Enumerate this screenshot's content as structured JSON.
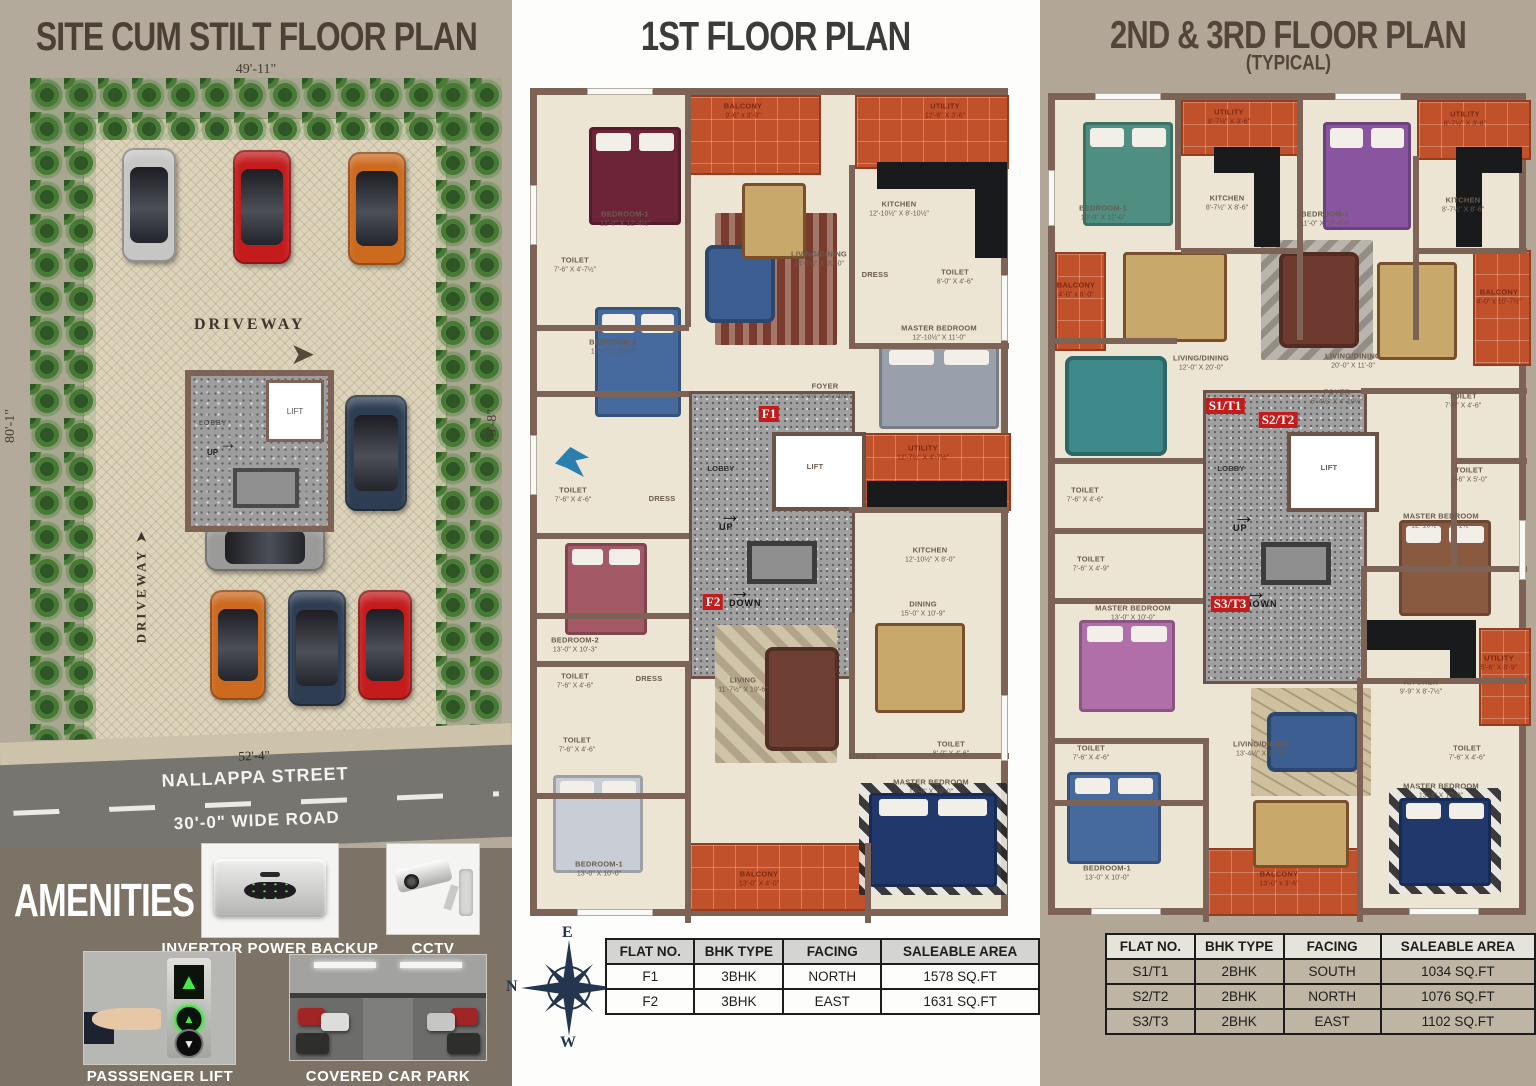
{
  "site_plan": {
    "title": "SITE CUM STILT FLOOR PLAN",
    "dim_top": "49'-11\"",
    "dim_left": "80'-1\"",
    "dim_right": "79'-8\"",
    "dim_bottom": "52'-4\"",
    "street_name": "NALLAPPA STREET",
    "road_width": "30'-0\" WIDE ROAD",
    "driveway_label": "DRIVEWAY",
    "lift": "LIFT",
    "lobby": "LOBBY",
    "up": "UP"
  },
  "first_floor": {
    "title": "1ST  FLOOR PLAN",
    "stair": {
      "up": "UP",
      "down": "DOWN"
    },
    "flat_tags": [
      "F1",
      "F2"
    ],
    "rooms": [
      {
        "name": "BALCONY",
        "dims": "9'-6\" x 3'-9\""
      },
      {
        "name": "UTILITY",
        "dims": "12'-6\" X 3'-6\""
      },
      {
        "name": "BEDROOM-1",
        "dims": "12'-0\" X 12'-4½\""
      },
      {
        "name": "KITCHEN",
        "dims": "12'-10½\" X 8'-10½\""
      },
      {
        "name": "LIVING/DINING",
        "dims": "14'-1½\" X 20'-0\""
      },
      {
        "name": "TOILET",
        "dims": "7'-6\" X 4'-7½\""
      },
      {
        "name": "DRESS"
      },
      {
        "name": "TOILET",
        "dims": "8'-0\" X 4'-6\""
      },
      {
        "name": "BEDROOM-2",
        "dims": "12'-0\" X 15'-0\""
      },
      {
        "name": "MASTER BEDROOM",
        "dims": "12'-10½\" X 11'-0\""
      },
      {
        "name": "FOYER",
        "dims": "5'-4½\" X 4'-10½\""
      },
      {
        "name": "LOBBY"
      },
      {
        "name": "LIFT"
      },
      {
        "name": "UTILITY",
        "dims": "12'-7½\" X 4'-7½\""
      },
      {
        "name": "TOILET",
        "dims": "7'-6\" X 4'-6\""
      },
      {
        "name": "DRESS"
      },
      {
        "name": "KITCHEN",
        "dims": "12'-10½\" X 8'-0\""
      },
      {
        "name": "DINING",
        "dims": "15'-0\" X 10'-9\""
      },
      {
        "name": "BEDROOM-2",
        "dims": "13'-0\" X 10'-3\""
      },
      {
        "name": "TOILET",
        "dims": "7'-6\" X 4'-6\""
      },
      {
        "name": "DRESS"
      },
      {
        "name": "LIVING",
        "dims": "11'-7½\" X 19'-6\""
      },
      {
        "name": "TOILET",
        "dims": "7'-6\" X 4'-6\""
      },
      {
        "name": "DRESS"
      },
      {
        "name": "TOILET",
        "dims": "8'-0\" X 4'-6\""
      },
      {
        "name": "MASTER BEDROOM",
        "dims": "15'-0\" X 10'-0\""
      },
      {
        "name": "BEDROOM-1",
        "dims": "13'-0\" X 10'-0\""
      },
      {
        "name": "BALCONY",
        "dims": "13'-0\" X 4'-0\""
      }
    ]
  },
  "typical_floor": {
    "title": "2ND & 3RD FLOOR PLAN",
    "subtitle": "(TYPICAL)",
    "stair": {
      "up": "UP",
      "down": "DOWN"
    },
    "flat_tags": [
      "S1/T1",
      "S2/T2",
      "S3/T3"
    ],
    "rooms": [
      {
        "name": "BEDROOM-1",
        "dims": "10'-0\" X 12'-0\""
      },
      {
        "name": "UTILITY",
        "dims": "8'-7½\" X 3'-6\""
      },
      {
        "name": "KITCHEN",
        "dims": "8'-7½\" X 8'-6\""
      },
      {
        "name": "BEDROOM-1",
        "dims": "11'-0\" X 12'-4½\""
      },
      {
        "name": "UTILITY",
        "dims": "8'-7½\" X 3'-6\""
      },
      {
        "name": "KITCHEN",
        "dims": "8'-7½\" X 8'-6\""
      },
      {
        "name": "BALCONY",
        "dims": "4'-0\" x 8'-0\""
      },
      {
        "name": "LIVING/DINING",
        "dims": "12'-0\" X 20'-0\""
      },
      {
        "name": "LIVING/DINING",
        "dims": "20'-0\" X 11'-0\""
      },
      {
        "name": "BALCONY",
        "dims": "4'-0\" x 10'-7½\""
      },
      {
        "name": "FOYER",
        "dims": "5'-4½\" X 4'-10½\""
      },
      {
        "name": "TOILET",
        "dims": "7'-6\" X 4'-6\""
      },
      {
        "name": "LOBBY"
      },
      {
        "name": "LIFT"
      },
      {
        "name": "TOILET",
        "dims": "7'-6\" X 5'-0\""
      },
      {
        "name": "TOILET",
        "dims": "7'-6\" X 4'-6\""
      },
      {
        "name": "TOILET",
        "dims": "7'-6\" X 4'-9\""
      },
      {
        "name": "MASTER BEDROOM",
        "dims": "12'-10½\" X 10'-1½\""
      },
      {
        "name": "MASTER BEDROOM",
        "dims": "13'-0\" X 10'-0\""
      },
      {
        "name": "KITCHEN",
        "dims": "9'-9\" X 8'-7½\""
      },
      {
        "name": "UTILITY",
        "dims": "5'-6\" X 8'-9\""
      },
      {
        "name": "TOILET",
        "dims": "7'-6\" X 4'-6\""
      },
      {
        "name": "LIVING/DINING",
        "dims": "13'-4½\" X 20'-0\""
      },
      {
        "name": "TOILET",
        "dims": "7'-6\" X 4'-6\""
      },
      {
        "name": "MASTER BEDROOM",
        "dims": "13'-3\" X 10'-0\""
      },
      {
        "name": "BEDROOM-1",
        "dims": "13'-0\" X 10'-0\""
      },
      {
        "name": "BALCONY",
        "dims": "13'-0\" x 3'-6\""
      }
    ]
  },
  "amenities": {
    "title": "AMENITIES",
    "items": [
      "INVERTOR POWER BACKUP",
      "CCTV",
      "PASSSENGER LIFT",
      "COVERED CAR PARK"
    ]
  },
  "compass": {
    "n": "N",
    "e": "E",
    "s": "S",
    "w": "W"
  },
  "tables": {
    "first_floor": {
      "headers": [
        "FLAT NO.",
        "BHK TYPE",
        "FACING",
        "SALEABLE AREA"
      ],
      "rows": [
        [
          "F1",
          "3BHK",
          "NORTH",
          "1578 SQ.FT"
        ],
        [
          "F2",
          "3BHK",
          "EAST",
          "1631 SQ.FT"
        ]
      ]
    },
    "typical": {
      "headers": [
        "FLAT NO.",
        "BHK TYPE",
        "FACING",
        "SALEABLE AREA"
      ],
      "rows": [
        [
          "S1/T1",
          "2BHK",
          "SOUTH",
          "1034 SQ.FT"
        ],
        [
          "S2/T2",
          "2BHK",
          "NORTH",
          "1076 SQ.FT"
        ],
        [
          "S3/T3",
          "2BHK",
          "EAST",
          "1102 SQ.FT"
        ]
      ]
    }
  },
  "colors": {
    "terracotta": "#c0512b",
    "wall_brown": "#7d6355",
    "floor_cream": "#ece5d4",
    "flat_tag_red": "#c21d1d",
    "compass_navy": "#24354f",
    "panel_taupe": "#b4aa9b",
    "amenities_bg": "#7c7265",
    "road_gray": "#76756f"
  }
}
